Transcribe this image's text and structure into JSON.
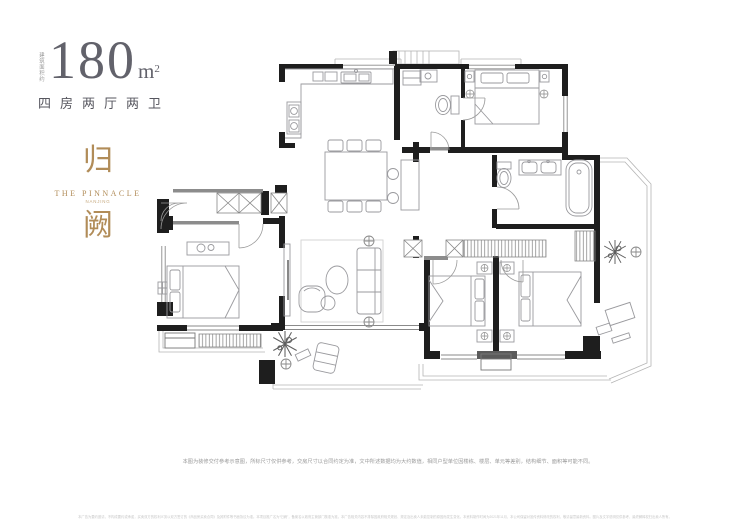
{
  "header": {
    "area_prefix": "建筑面积约",
    "area_value": "180",
    "area_unit": "m",
    "area_sup": "2",
    "layout_label": "四房两厅两卫"
  },
  "brand": {
    "char_top": "归",
    "name_en": "THE PINNACLE",
    "name_sub": "NANJING",
    "char_bottom": "阙",
    "accent_color": "#b18c58"
  },
  "plan_style": {
    "wall_color": "#1e1e1e",
    "secondary_wall_color": "#8c8c8c",
    "furniture_line_color": "#9a9a9e",
    "background": "#ffffff"
  },
  "footer": {
    "disclaimer": "本图为装修交付参考示意图，所标尺寸仅供参考，交房尺寸以合同约定为准，文中所述数据均为大约数值，相同户型单位因楼栋、楼层、单元等差别，结构细节、面积等可能不同。",
    "fineprint": "本广告为要约邀请，不构成要约或承诺，买卖双方的权利义务以双方签订的《商品房买卖合同》及其附件等书面协议为准。本项目推广名为“归阙”，备案名以政府主管部门核准为准。本广告相关内容不排除因政府相关规划、规定及出卖人未能控制的原因而发生变化。本资料制作时间为2021年11月，本公司保留对宣传资料修改的权利，敬请留意最新资料。图片及文字说明仅供参考，最终解释权归出卖人所有。"
  }
}
